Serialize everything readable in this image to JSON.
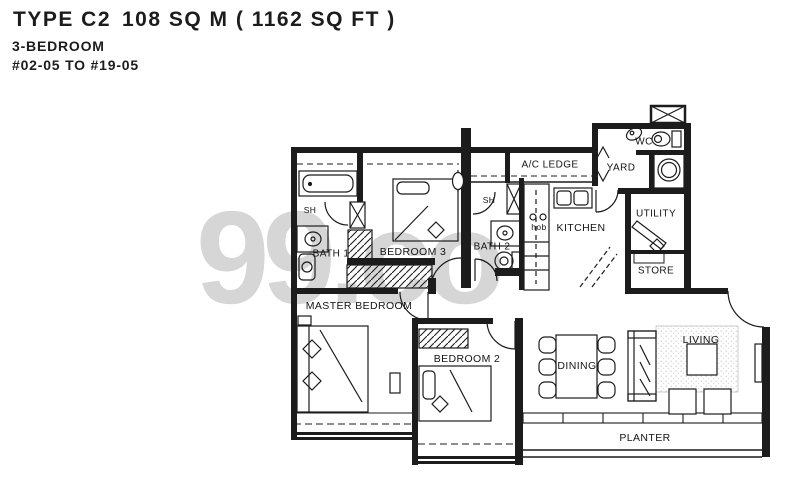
{
  "header": {
    "type": "TYPE C2",
    "area": "108 SQ M ( 1162 SQ FT )",
    "bedrooms": "3-BEDROOM",
    "units": "#02-05 TO #19-05"
  },
  "watermark": "99.co",
  "rooms": {
    "bath1": "BATH 1",
    "sh1": "SH",
    "bedroom3": "BEDROOM 3",
    "bath2": "BATH 2",
    "sh2": "SH",
    "ac_ledge": "A/C LEDGE",
    "yard": "YARD",
    "wc": "WC",
    "kitchen": "KITCHEN",
    "hob": "hob",
    "utility": "UTILITY",
    "store": "STORE",
    "master_bedroom": "MASTER BEDROOM",
    "bedroom2": "BEDROOM 2",
    "dining": "DINING",
    "living": "LIVING",
    "planter": "PLANTER"
  },
  "colors": {
    "line": "#1c1c1c",
    "watermark": "#d6d6d6"
  }
}
